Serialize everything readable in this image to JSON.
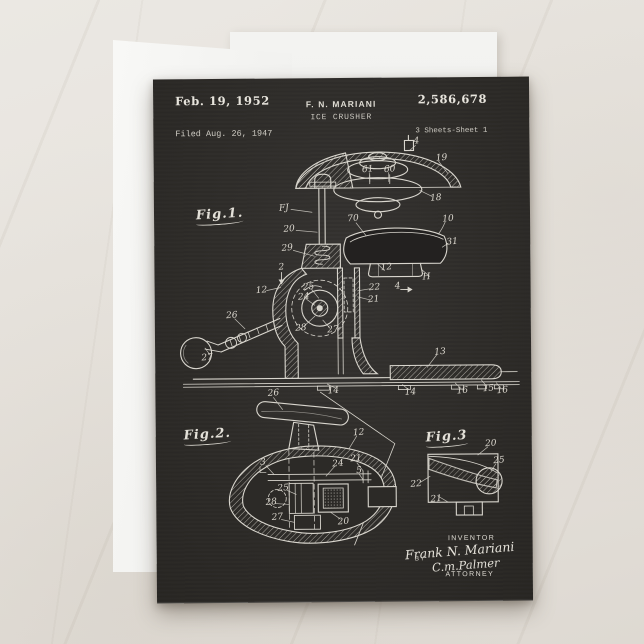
{
  "colors": {
    "marble": "#e7e3dd",
    "backing_card": "#f2f2f0",
    "chalkboard": "#2d2b28",
    "chalk_text": "#e8e5dd",
    "chalk_line": "#d9d6ce"
  },
  "header": {
    "date": "Feb. 19, 1952",
    "inventor": "F. N. MARIANI",
    "title": "ICE CRUSHER",
    "number": "2,586,678",
    "filed": "Filed Aug. 26, 1947",
    "sheets": "3 Sheets-Sheet 1"
  },
  "figures": {
    "fig1": {
      "label": "Fig.1."
    },
    "fig2": {
      "label": "Fig.2."
    },
    "fig3": {
      "label": "Fig.3"
    }
  },
  "signature": {
    "inventor_caption": "INVENTOR",
    "inventor_signature": "Frank N. Mariani",
    "by": "BY",
    "attorney_signature": "C.m.Palmer",
    "attorney_caption": "ATTORNEY"
  },
  "callouts": {
    "fig1": [
      {
        "t": "4",
        "x": 263,
        "y": 64
      },
      {
        "t": "19",
        "x": 288,
        "y": 81
      },
      {
        "t": "61",
        "x": 214,
        "y": 92
      },
      {
        "t": "60",
        "x": 236,
        "y": 92
      },
      {
        "t": "18",
        "x": 282,
        "y": 121
      },
      {
        "t": "FJ",
        "x": 130,
        "y": 130
      },
      {
        "t": "20",
        "x": 135,
        "y": 151
      },
      {
        "t": "70",
        "x": 199,
        "y": 141
      },
      {
        "t": "10",
        "x": 294,
        "y": 142
      },
      {
        "t": "31",
        "x": 298,
        "y": 165
      },
      {
        "t": "29",
        "x": 133,
        "y": 170
      },
      {
        "t": "2",
        "x": 127,
        "y": 189
      },
      {
        "t": "12",
        "x": 107,
        "y": 212
      },
      {
        "t": "25",
        "x": 154,
        "y": 209
      },
      {
        "t": "24",
        "x": 149,
        "y": 219
      },
      {
        "t": "28",
        "x": 146,
        "y": 250
      },
      {
        "t": "27",
        "x": 178,
        "y": 252
      },
      {
        "t": "22",
        "x": 220,
        "y": 210
      },
      {
        "t": "21",
        "x": 219,
        "y": 222
      },
      {
        "t": "4",
        "x": 243,
        "y": 209
      },
      {
        "t": "12",
        "x": 232,
        "y": 190
      },
      {
        "t": "H",
        "x": 272,
        "y": 200
      },
      {
        "t": "26",
        "x": 77,
        "y": 237
      },
      {
        "t": "27",
        "x": 52,
        "y": 279
      },
      {
        "t": "13",
        "x": 285,
        "y": 275
      },
      {
        "t": "14",
        "x": 178,
        "y": 313
      },
      {
        "t": "14",
        "x": 255,
        "y": 315
      },
      {
        "t": "16",
        "x": 307,
        "y": 314
      },
      {
        "t": "15",
        "x": 333,
        "y": 312
      },
      {
        "t": "16",
        "x": 347,
        "y": 314
      }
    ],
    "fig2": [
      {
        "t": "26",
        "x": 118,
        "y": 315
      },
      {
        "t": "12",
        "x": 203,
        "y": 355
      },
      {
        "t": "3",
        "x": 107,
        "y": 384
      },
      {
        "t": "24",
        "x": 182,
        "y": 386
      },
      {
        "t": "21",
        "x": 200,
        "y": 381
      },
      {
        "t": "5",
        "x": 203,
        "y": 393
      },
      {
        "t": "25",
        "x": 127,
        "y": 410
      },
      {
        "t": "28",
        "x": 115,
        "y": 424
      },
      {
        "t": "27",
        "x": 121,
        "y": 439
      },
      {
        "t": "20",
        "x": 187,
        "y": 444
      }
    ],
    "fig3": [
      {
        "t": "20",
        "x": 335,
        "y": 367
      },
      {
        "t": "25",
        "x": 343,
        "y": 384
      },
      {
        "t": "22",
        "x": 260,
        "y": 407
      },
      {
        "t": "21",
        "x": 280,
        "y": 422
      }
    ]
  }
}
